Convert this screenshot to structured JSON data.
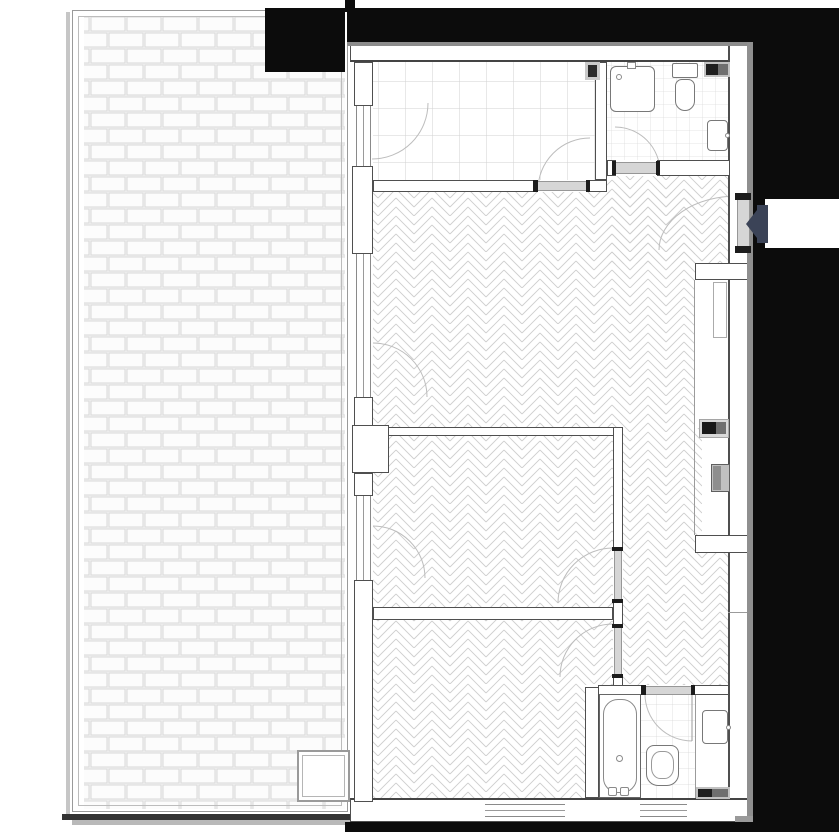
{
  "document": {
    "type": "architectural floor plan",
    "title": "Apartment floor plan with terrace",
    "orientation": "terrace on left, apartment on right, entrance on right side"
  },
  "palette": {
    "background": "#ffffff",
    "exterior_mass": "#0c0c0c",
    "wall_outline": "#4f4f4f",
    "pattern_line": "#cfcfcf",
    "threshold": "#d6d6d6",
    "shadow_gray": "#8c8c8c",
    "entrance_arrow": "#3b4357",
    "fixture_dark": "#1f1f1f",
    "fixture_mid": "#6f6f6f"
  },
  "terrace": {
    "floor_pattern": "brick running bond paving",
    "features": [
      "perimeter double-line curb",
      "floor drain / skylight square at bottom right"
    ]
  },
  "rooms": [
    {
      "id": "kitchen",
      "floor_pattern": "square tile 27px",
      "fixtures": [
        "wall vent"
      ],
      "doors": [
        "terrace glazed door",
        "door to living room"
      ]
    },
    {
      "id": "bathroom-top",
      "floor_pattern": "square tile 13px",
      "fixtures": [
        "shower tray with drain",
        "wall-hung toilet",
        "washbasin",
        "duct vent"
      ],
      "doors": [
        "door from entrance hall"
      ]
    },
    {
      "id": "living-room",
      "floor_pattern": "herringbone parquet",
      "doors": [
        "terrace glazed door"
      ],
      "features": [
        "chimney pier on left wall"
      ]
    },
    {
      "id": "entrance-hall",
      "floor_pattern": "herringbone parquet",
      "doors": [
        "apartment entrance door with arrow marker"
      ],
      "features": [
        "service niche with electrical panel and riser duct"
      ]
    },
    {
      "id": "bedroom-1",
      "floor_pattern": "herringbone parquet",
      "doors": [
        "terrace glazed door",
        "door to hall"
      ]
    },
    {
      "id": "bedroom-2",
      "floor_pattern": "herringbone parquet",
      "doors": [
        "door to hall"
      ],
      "windows": [
        "bottom wall window"
      ]
    },
    {
      "id": "bathroom-bottom",
      "floor_pattern": "square tile 16px",
      "fixtures": [
        "bathtub with drain and taps",
        "toilet",
        "washbasin",
        "radiator"
      ],
      "doors": [
        "door from hall"
      ]
    }
  ],
  "counts": {
    "glazed_openings_left_wall": 3,
    "bottom_wall_windows": 2,
    "interior_doors": 6,
    "entrance_doors": 1
  },
  "entrance": {
    "marker": "dark navy arrow pointing left into apartment",
    "arrow_color": "#3b4357"
  }
}
